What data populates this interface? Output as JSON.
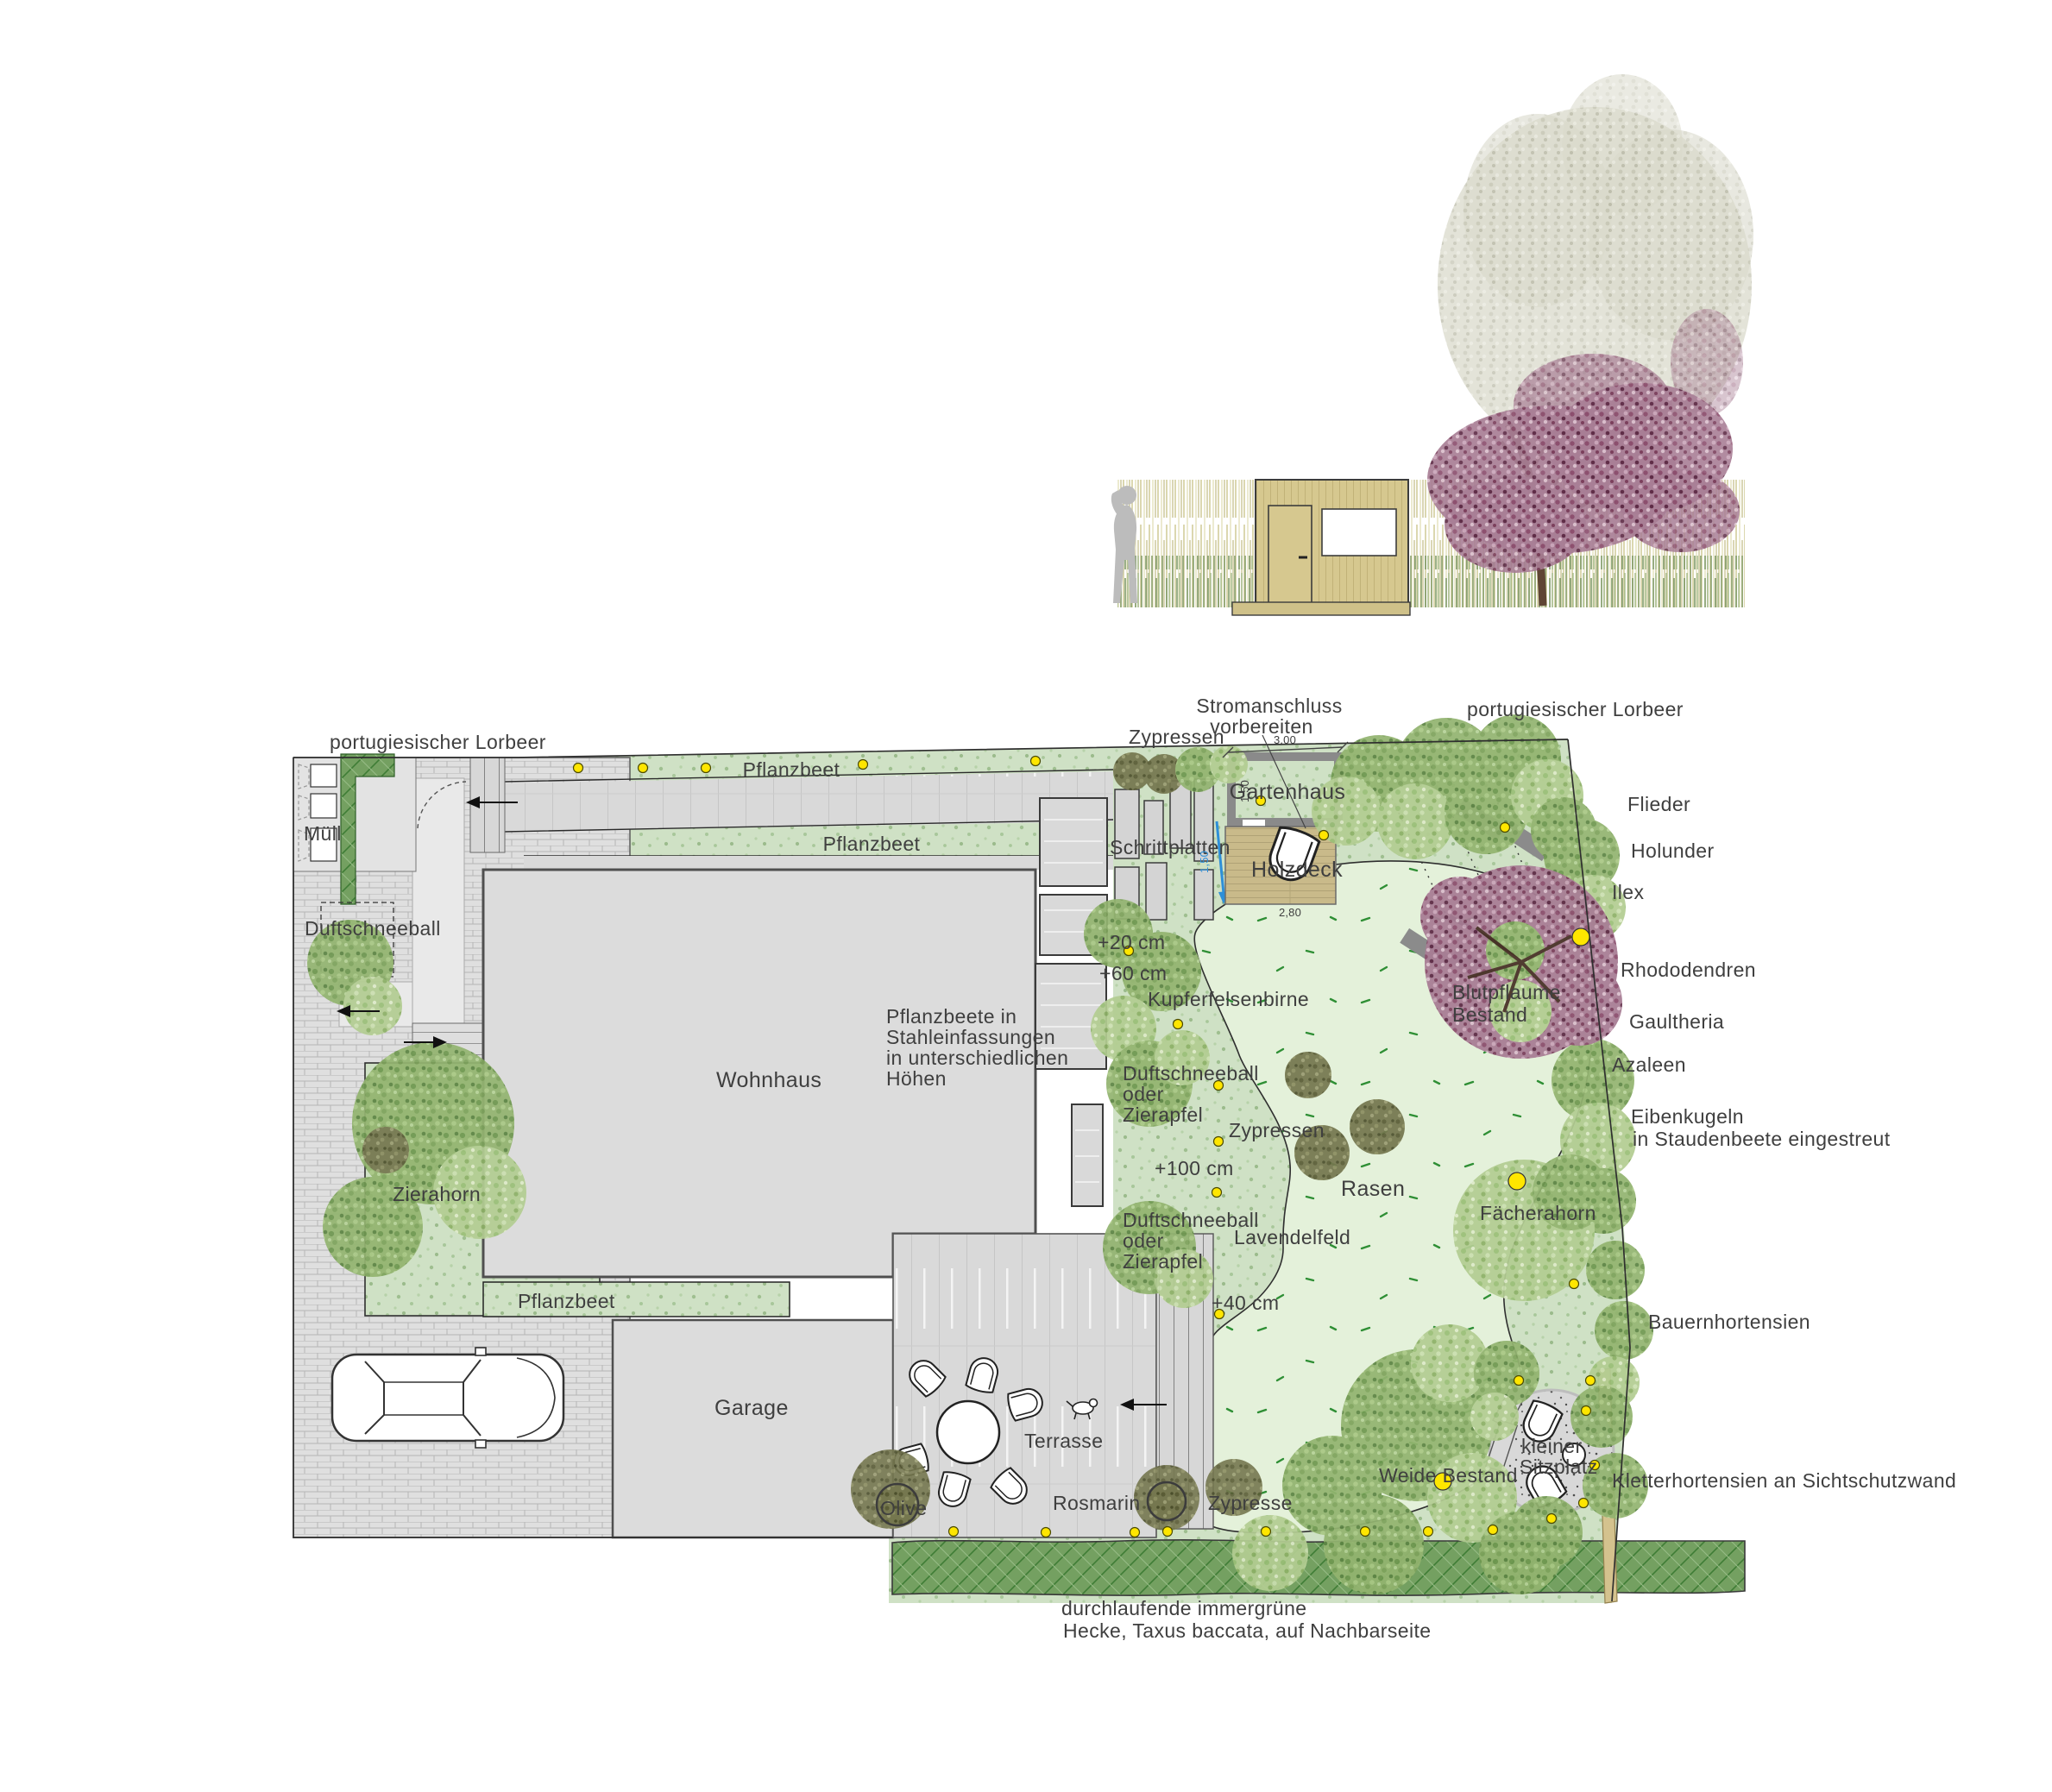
{
  "plan": {
    "labels": {
      "lorbeer": "portugiesischer Lorbeer",
      "stromanschluss_line1": "Stromanschluss",
      "stromanschluss_line2": "vorbereiten",
      "zypressen": "Zypressen",
      "zypresse": "Zypresse",
      "pflanzbeet": "Pflanzbeet",
      "muell": "Müll",
      "duftschneeball": "Duftschneeball",
      "gartenhaus": "Gartenhaus",
      "schrittplatten": "Schrittplatten",
      "holzdeck": "Holzdeck",
      "flieder": "Flieder",
      "holunder": "Holunder",
      "ilex": "Ilex",
      "rhododendren": "Rhododendren",
      "gaultheria": "Gaultheria",
      "azaleen": "Azaleen",
      "eibenkugeln_line1": "Eibenkugeln",
      "eibenkugeln_line2": "in Staudenbeete eingestreut",
      "kupferfelsenbirne": "Kupferfelsenbirne",
      "duft_oder": "oder",
      "zierapfel": "Zierapfel",
      "rasen": "Rasen",
      "lavendelfeld": "Lavendelfeld",
      "blutpflaume_line1": "Blutpflaume",
      "blutpflaume_line2": "Bestand",
      "faecherahorn": "Fächerahorn",
      "bauernhortensien": "Bauernhortensien",
      "zierahorn": "Zierahorn",
      "weide_bestand": "Weide Bestand",
      "sitzplatz_line1": "kleiner",
      "sitzplatz_line2": "Sitzplatz",
      "kletterhortensien": "Kletterhortensien an Sichtschutzwand",
      "rosmarin": "Rosmarin",
      "olive": "Olive",
      "terrasse": "Terrasse",
      "garage": "Garage",
      "wohnhaus": "Wohnhaus",
      "stahl_line1": "Pflanzbeete in",
      "stahl_line2": "Stahleinfassungen",
      "stahl_line3": "in unterschiedlichen",
      "stahl_line4": "Höhen",
      "hecke_line1": "durchlaufende immergrüne",
      "hecke_line2": "Hecke, Taxus baccata, auf Nachbarseite"
    },
    "heights": {
      "h20": "+20 cm",
      "h40": "+40 cm",
      "h60": "+60 cm",
      "h100": "+100 cm"
    },
    "dimensions": {
      "gartenhaus_width": "3,00",
      "gartenhaus_depth": "1,50",
      "holzdeck_width": "2,80",
      "water_channel": "1,50"
    },
    "colors": {
      "lawn": "#e4f1da",
      "planting_bed": "#cfe1c5",
      "hedge": "#74a061",
      "wood_deck": "#c9ba8a",
      "boundary_wall": "#d4c28e",
      "water": "#2e8fd8",
      "light_dot": "#ffe600",
      "paving": "#dfdfdf",
      "building": "#dcdcdc"
    }
  }
}
